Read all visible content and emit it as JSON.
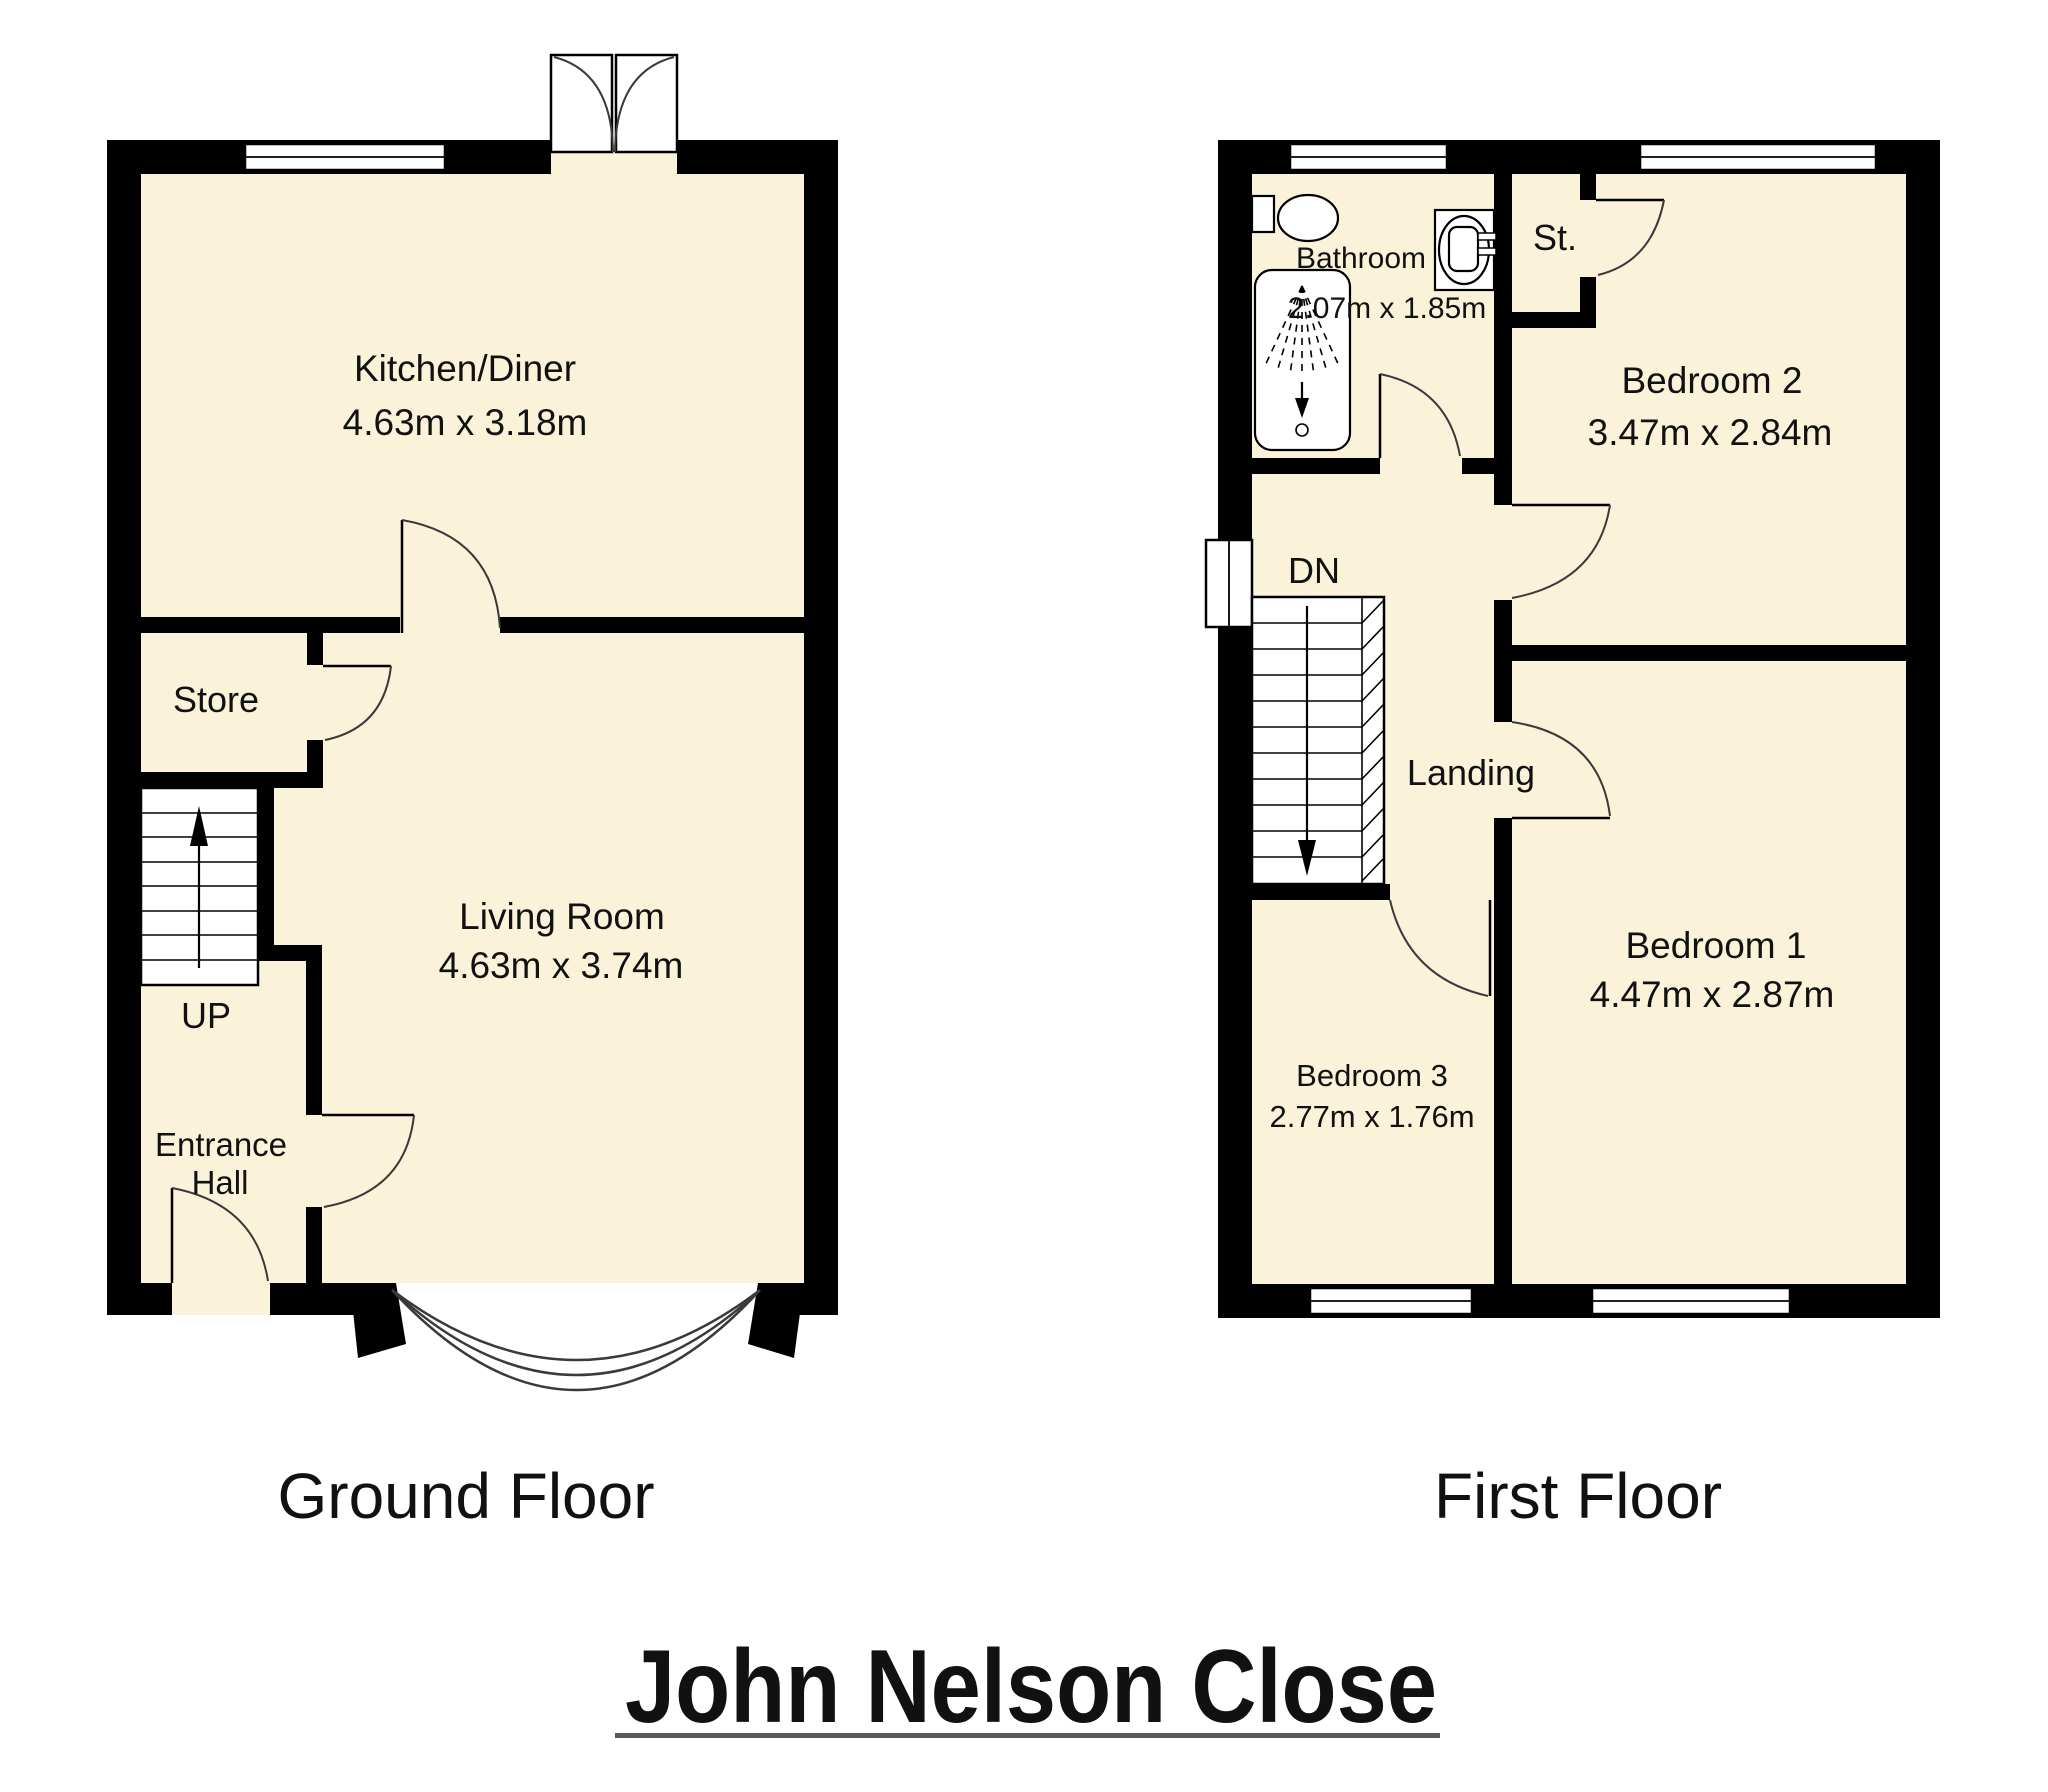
{
  "title": "John Nelson Close",
  "floors": {
    "ground": {
      "name": "Ground Floor",
      "stairs_label": "UP",
      "rooms": {
        "kitchen": {
          "label": "Kitchen/Diner",
          "dims": "4.63m x 3.18m"
        },
        "store": {
          "label": "Store"
        },
        "living": {
          "label": "Living Room",
          "dims": "4.63m x 3.74m"
        },
        "entrance": {
          "line1": "Entrance",
          "line2": "Hall"
        }
      }
    },
    "first": {
      "name": "First Floor",
      "stairs_label": "DN",
      "rooms": {
        "bathroom": {
          "label": "Bathroom",
          "dims": "2.07m x 1.85m"
        },
        "st": {
          "label": "St."
        },
        "bedroom2": {
          "label": "Bedroom 2",
          "dims": "3.47m x 2.84m"
        },
        "landing": {
          "label": "Landing"
        },
        "bedroom3": {
          "label": "Bedroom 3",
          "dims": "2.77m x 1.76m"
        },
        "bedroom1": {
          "label": "Bedroom 1",
          "dims": "4.47m x 2.87m"
        }
      }
    }
  },
  "colors": {
    "floor_fill": "#faf3da",
    "wall": "#000000",
    "underline": "#595959"
  }
}
